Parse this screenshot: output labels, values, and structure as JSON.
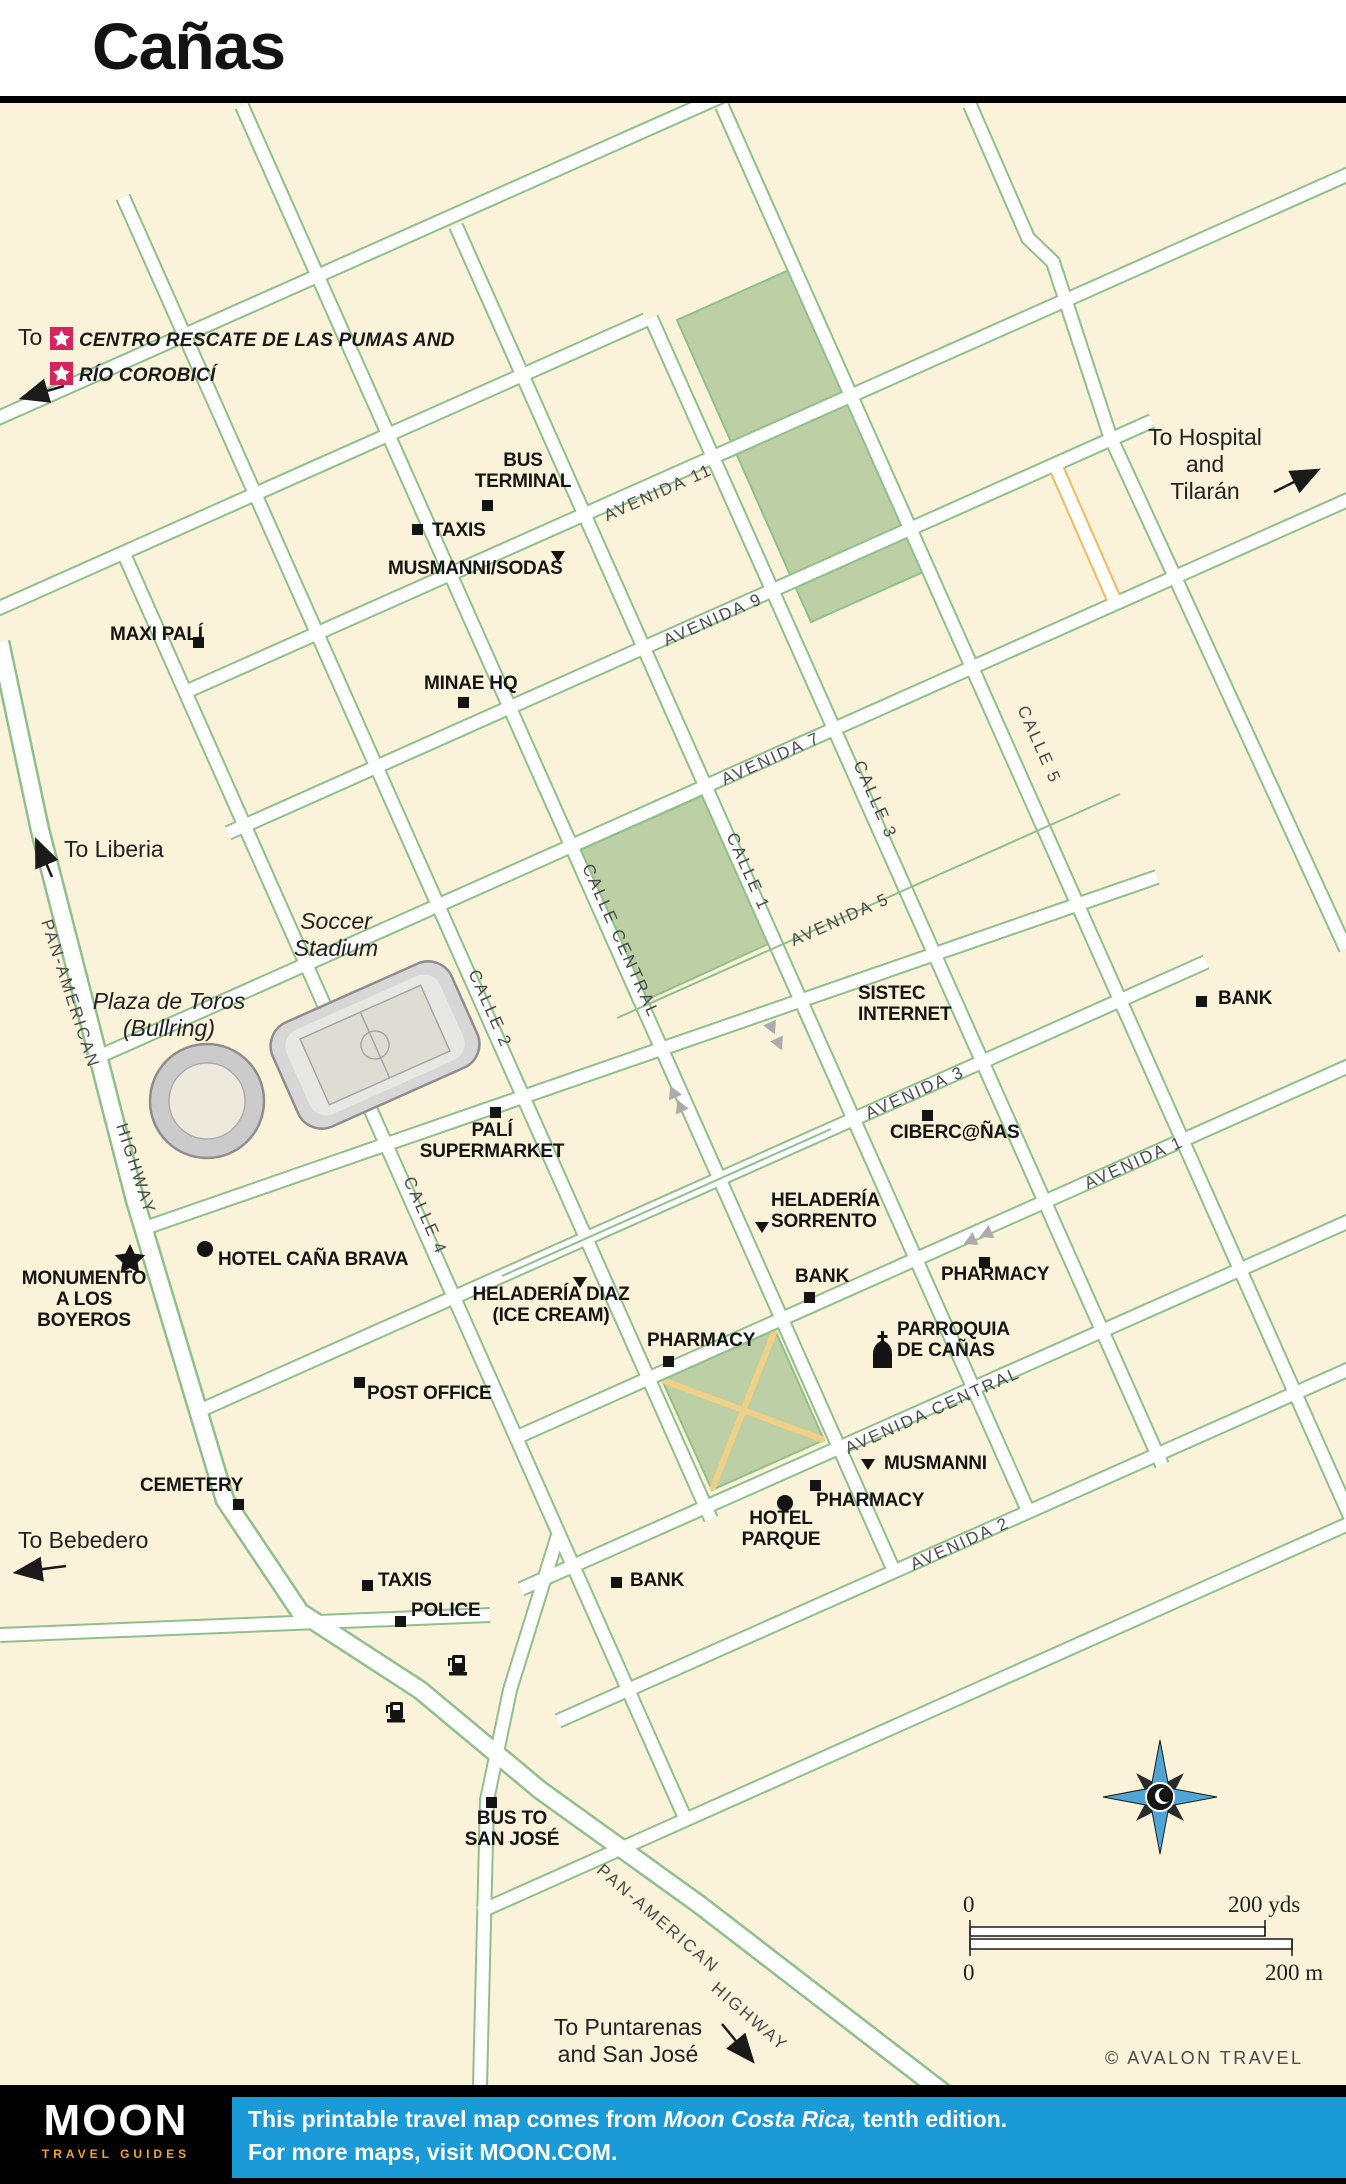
{
  "title": "Cañas",
  "directions": {
    "rescate_to": "To",
    "rescate_line1": "CENTRO RESCATE DE LAS PUMAS AND",
    "rescate_line2": "RÍO COROBICÍ",
    "hospital": "To Hospital and\nTilarán",
    "liberia": "To Liberia",
    "bebedero": "To Bebedero",
    "puntarenas": "To Puntarenas\nand San José"
  },
  "landmarks": {
    "stadium": "Soccer\nStadium",
    "bullring": "Plaza de Toros\n(Bullring)"
  },
  "streets": {
    "avenida11": "AVENIDA 11",
    "avenida9": "AVENIDA 9",
    "avenida7": "AVENIDA 7",
    "avenida5": "AVENIDA 5",
    "avenida3": "AVENIDA 3",
    "avenida1": "AVENIDA 1",
    "avenida_central": "AVENIDA CENTRAL",
    "avenida2": "AVENIDA 2",
    "calle_central": "CALLE CENTRAL",
    "calle1": "CALLE 1",
    "calle2": "CALLE 2",
    "calle3": "CALLE 3",
    "calle4": "CALLE 4",
    "calle5": "CALLE 5",
    "panamerican": "PAN-AMERICAN",
    "highway": "HIGHWAY"
  },
  "pois": {
    "bus_terminal": "BUS\nTERMINAL",
    "taxis_n": "TAXIS",
    "musmanni_sodas": "MUSMANNI/SODAS",
    "maxi_pali": "MAXI PALÍ",
    "minae": "MINAE HQ",
    "sistec": "SISTEC\nINTERNET",
    "bank_ne": "BANK",
    "cibercanas": "CIBERC@ÑAS",
    "pali_supermarket": "PALÍ\nSUPERMARKET",
    "heladeria_sorrento": "HELADERÍA\nSORRENTO",
    "bank_c": "BANK",
    "pharmacy_e": "PHARMACY",
    "hotel_cana_brava": "HOTEL CAÑA BRAVA",
    "monumento": "MONUMENTO\nA LOS\nBOYEROS",
    "heladeria_diaz": "HELADERÍA DIAZ\n(ICE CREAM)",
    "pharmacy_c": "PHARMACY",
    "parroquia": "PARROQUIA\nDE CAÑAS",
    "post_office": "POST OFFICE",
    "cemetery": "CEMETERY",
    "musmanni_s": "MUSMANNI",
    "pharmacy_s": "PHARMACY",
    "hotel_parque": "HOTEL\nPARQUE",
    "taxis_s": "TAXIS",
    "police": "POLICE",
    "bank_s": "BANK",
    "bus_san_jose": "BUS TO\nSAN JOSÉ"
  },
  "scale": {
    "zero_top": "0",
    "yds": "200 yds",
    "zero_bottom": "0",
    "m": "200 m",
    "credit": "© AVALON TRAVEL"
  },
  "footer": {
    "logo_main": "MOON",
    "logo_sub": "TRAVEL GUIDES",
    "line1_prefix": "This printable travel map comes from ",
    "line1_italic": "Moon Costa Rica,",
    "line1_suffix": " tenth edition.",
    "line2": "For more maps, visit MOON.COM."
  },
  "colors": {
    "map_background": "#FBF2DA",
    "road_casing_green": "#8FC08C",
    "park_green": "#BDCFA4",
    "path_yellow": "#EFD086",
    "bridge_orange": "#F2B95C",
    "footer_blue": "#1B9AD8",
    "logo_gold": "#F5A51C",
    "star_red": "#D6245F",
    "compass_blue": "#4FA6D6"
  }
}
